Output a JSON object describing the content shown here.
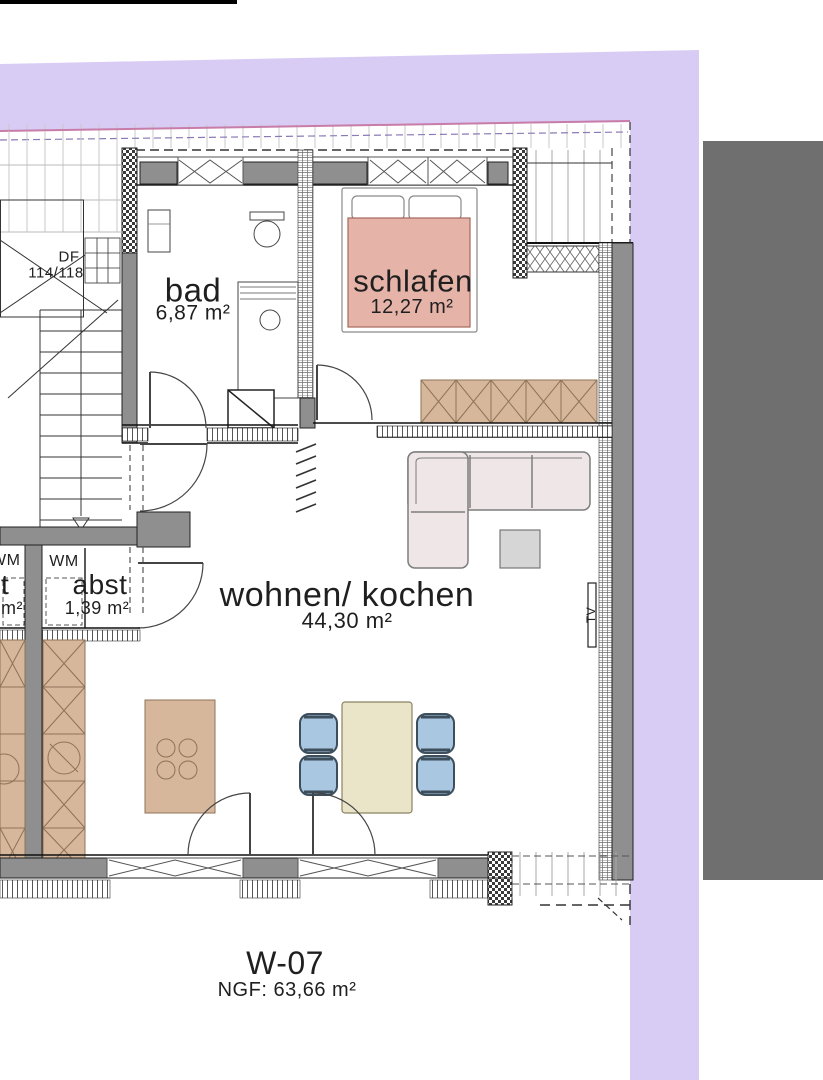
{
  "plan": {
    "unit": {
      "code": "W-07",
      "area_label": "NGF: 63,66 m²"
    },
    "rooms": [
      {
        "key": "bad",
        "name": "bad",
        "area": "6,87 m²"
      },
      {
        "key": "schlafen",
        "name": "schlafen",
        "area": "12,27 m²"
      },
      {
        "key": "abst",
        "name": "abst",
        "area": "1,39 m²"
      },
      {
        "key": "wohnen",
        "name": "wohnen/ kochen",
        "area": "44,30 m²"
      }
    ],
    "annotations": {
      "wm": "WM",
      "wm_left": "WM",
      "df": "DF",
      "df_size": "114/118",
      "tv": "TV",
      "cut_room_tail": "t",
      "cut_area_tail": "m²"
    }
  },
  "colors": {
    "purple": "#d8ccf5",
    "gray_panel": "#6f6f6f",
    "wall": "#8f8f8f",
    "line": "#1c1c1c",
    "tan": "#d6b79b",
    "tan_line": "#8d7358",
    "bed_pink": "#e6b3a8",
    "bed_line": "#a5685c",
    "table_cream": "#eae5c9",
    "chair_blue": "#a9c7e1",
    "chair_line": "#3d4e5c",
    "sofa_fill": "#efe7e7",
    "sofa_line": "#7d7d7d",
    "side_table": "#d6d6d6",
    "roof_pink_line": "#c87ca8",
    "text": "#1f1f1f"
  }
}
